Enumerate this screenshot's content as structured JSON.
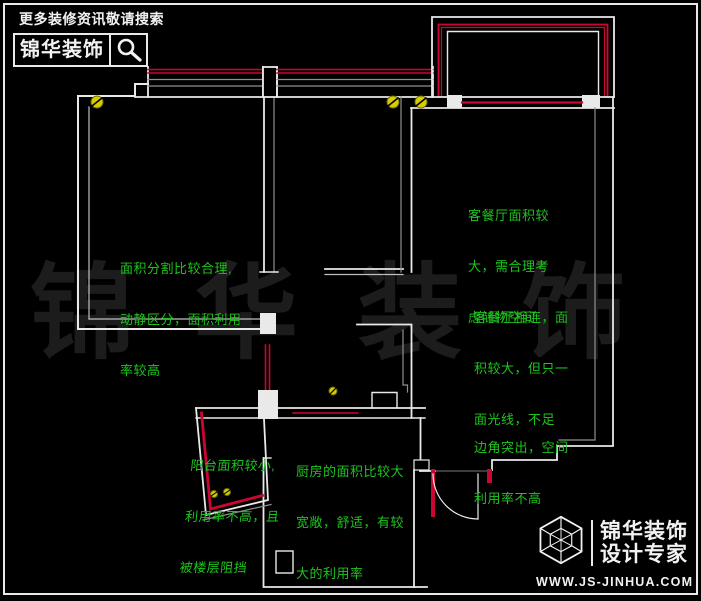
{
  "header": {
    "tagline": "更多装修资讯敬请搜索",
    "brand": "锦华装饰",
    "search_icon": "magnifier"
  },
  "watermark": "锦华装饰",
  "annotations": {
    "bedroom_main": {
      "lines": [
        "面积分割比较合理,",
        "动静区分，面积利用",
        "率较高"
      ]
    },
    "living_storage": {
      "lines": [
        "客餐厅面积较",
        "大，需合理考",
        "虑储物空间"
      ]
    },
    "living_light": {
      "lines": [
        "客餐厅相连，面",
        "积较大，但只一",
        "面光线，不足"
      ]
    },
    "corner": {
      "lines": [
        "边角突出，空间",
        "利用率不高"
      ]
    },
    "balcony": {
      "lines": [
        "阳台面积较小,",
        "利用率不高，且",
        "被楼层阻挡"
      ]
    },
    "kitchen": {
      "lines": [
        "厨房的面积比较大",
        "宽敞，舒适，有较",
        "大的利用率"
      ]
    }
  },
  "footer_logo": {
    "brand_line1": "锦华装饰",
    "brand_line2": "设计专家",
    "website": "WWW.JS-JINHUA.COM",
    "cube_icon": "wireframe-cube"
  },
  "colors": {
    "background": "#000000",
    "wall_white": "#e9e9e9",
    "wall_gray": "#8f8f8f",
    "window_red": "#cc0633",
    "annotation_green": "#1fc41f",
    "light_yellow": "#d6cc00",
    "watermark_gray": "#1c1c1c",
    "text_white": "#f2f2f2"
  }
}
